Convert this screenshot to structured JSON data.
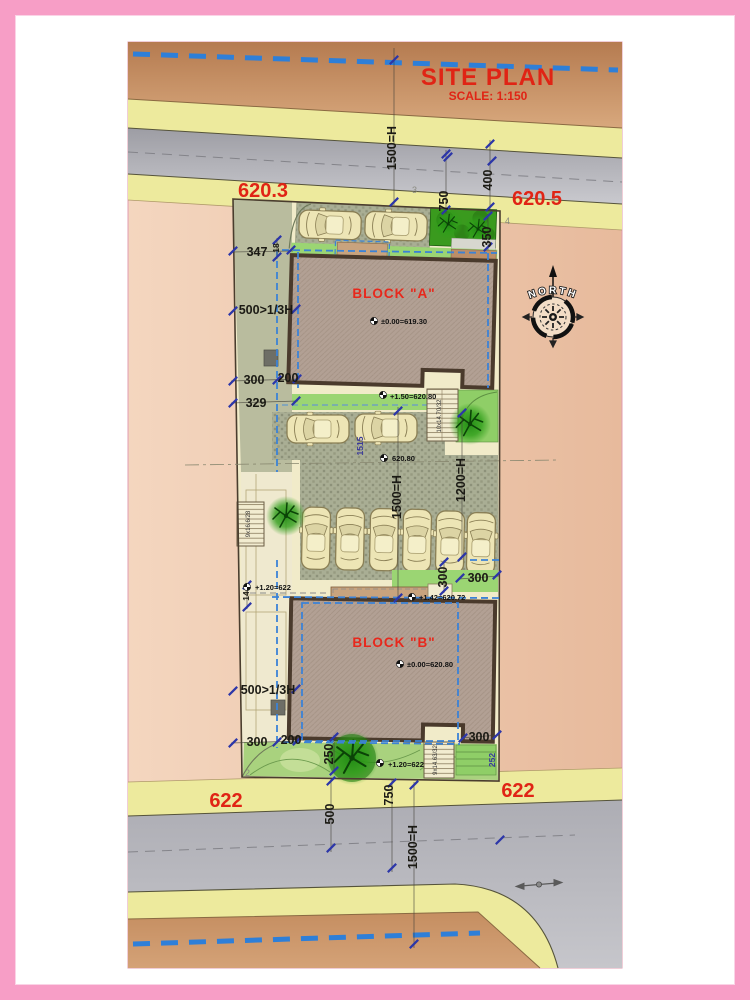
{
  "title": {
    "main": "SITE PLAN",
    "scale": "SCALE: 1:150"
  },
  "street_levels": {
    "top_left": "620.3",
    "top_right": "620.5",
    "bottom_left": "622",
    "bottom_right": "622"
  },
  "blocks": {
    "a": {
      "label": "BLOCK \"A\"",
      "level": "±0.00=619.30"
    },
    "b": {
      "label": "BLOCK \"B\"",
      "level": "±0.00=620.80"
    }
  },
  "spot_levels": {
    "below_a": "+1.50=620.80",
    "court": "620.80",
    "above_b": "+1.42=620.72",
    "left_court": "+1.20=622",
    "garden": "+1.20=622"
  },
  "dims": {
    "front_setback": "347",
    "side_gap_a": "500>1/3H",
    "d300_a": "300",
    "d200_a": "200",
    "d329": "329",
    "d18": "18",
    "d14": "14",
    "d1515": "1515",
    "side_gap_b": "500>1/3H",
    "d300_b": "300",
    "d200_b": "200",
    "d300_b_right": "300",
    "d300_mid_v": "300",
    "d300_mid_h": "300",
    "d350": "350",
    "d400": "400",
    "d750_top": "750",
    "d750_bottom": "750",
    "d500_bottom": "500",
    "d250": "250",
    "d252": "252",
    "h1500_top": "1500=H",
    "h1500_mid": "1500=H",
    "h1500_bottom": "1500=H",
    "h1200": "1200=H"
  },
  "stairs": {
    "below_a": "10x14.70/32",
    "court_left": "9x16.6/28",
    "below_b": "9x14.63/32"
  },
  "compass": {
    "label": "NORTH"
  },
  "corner_points": {
    "p2": "2",
    "p3": "3",
    "p4": "4"
  },
  "colors": {
    "accent_red": "#e02415",
    "dash_blue": "#2e7fd8",
    "road_gray": "#b5b5bb",
    "sidewalk_yellow": "#edea9d",
    "block_fill": "#b2a094",
    "plot_cream": "#f1ebc9",
    "tree_green": "#2f9e1a"
  }
}
